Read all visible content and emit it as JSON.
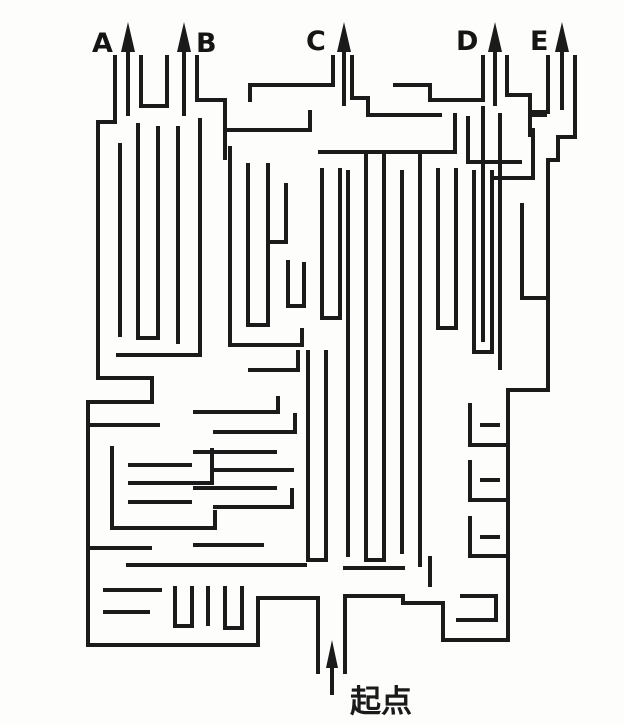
{
  "title": "maze-puzzle",
  "colors": {
    "background": "#fdfdfc",
    "wall": "#1b1b1b"
  },
  "wall_width": 4,
  "canvas": {
    "width": 624,
    "height": 725
  },
  "labels": {
    "a": "A",
    "b": "B",
    "c": "C",
    "d": "D",
    "e": "E",
    "start": "起点"
  },
  "arrows": [
    {
      "name": "exit-arrow-a",
      "x": 128,
      "shaft_y1": 116,
      "shaft_y2": 48,
      "tip_y": 22,
      "base_y": 52,
      "half_w": 7
    },
    {
      "name": "exit-arrow-b",
      "x": 184,
      "shaft_y1": 116,
      "shaft_y2": 48,
      "tip_y": 22,
      "base_y": 52,
      "half_w": 7
    },
    {
      "name": "exit-arrow-c",
      "x": 344,
      "shaft_y1": 106,
      "shaft_y2": 48,
      "tip_y": 22,
      "base_y": 52,
      "half_w": 7
    },
    {
      "name": "exit-arrow-d",
      "x": 495,
      "shaft_y1": 106,
      "shaft_y2": 48,
      "tip_y": 22,
      "base_y": 52,
      "half_w": 7
    },
    {
      "name": "exit-arrow-e",
      "x": 562,
      "shaft_y1": 110,
      "shaft_y2": 48,
      "tip_y": 22,
      "base_y": 52,
      "half_w": 7
    },
    {
      "name": "start-arrow",
      "x": 332,
      "shaft_y1": 695,
      "shaft_y2": 666,
      "tip_y": 640,
      "base_y": 668,
      "half_w": 6
    }
  ],
  "walls": [
    [
      [
        115,
        57
      ],
      [
        115,
        122
      ],
      [
        98,
        122
      ],
      [
        98,
        378
      ],
      [
        152,
        378
      ],
      [
        152,
        402
      ],
      [
        88,
        402
      ],
      [
        88,
        645
      ],
      [
        258,
        645
      ],
      [
        258,
        598
      ],
      [
        318,
        598
      ],
      [
        318,
        672
      ]
    ],
    [
      [
        141,
        57
      ],
      [
        141,
        106
      ],
      [
        167,
        106
      ],
      [
        167,
        57
      ]
    ],
    [
      [
        197,
        57
      ],
      [
        197,
        100
      ],
      [
        225,
        100
      ],
      [
        225,
        158
      ]
    ],
    [
      [
        333,
        57
      ],
      [
        333,
        85
      ],
      [
        250,
        85
      ],
      [
        250,
        100
      ]
    ],
    [
      [
        352,
        57
      ],
      [
        352,
        98
      ],
      [
        368,
        98
      ],
      [
        368,
        115
      ],
      [
        440,
        115
      ]
    ],
    [
      [
        483,
        57
      ],
      [
        483,
        100
      ],
      [
        430,
        100
      ],
      [
        430,
        85
      ],
      [
        395,
        85
      ]
    ],
    [
      [
        507,
        57
      ],
      [
        507,
        95
      ],
      [
        530,
        95
      ],
      [
        530,
        115
      ],
      [
        545,
        115
      ]
    ],
    [
      [
        548,
        57
      ],
      [
        548,
        112
      ],
      [
        530,
        112
      ],
      [
        530,
        135
      ]
    ],
    [
      [
        575,
        57
      ],
      [
        575,
        137
      ],
      [
        558,
        137
      ],
      [
        558,
        160
      ],
      [
        548,
        160
      ],
      [
        548,
        390
      ],
      [
        508,
        390
      ],
      [
        508,
        640
      ],
      [
        443,
        640
      ],
      [
        443,
        603
      ],
      [
        403,
        603
      ],
      [
        403,
        596
      ],
      [
        345,
        596
      ],
      [
        345,
        672
      ]
    ],
    [
      [
        120,
        145
      ],
      [
        120,
        335
      ]
    ],
    [
      [
        138,
        125
      ],
      [
        138,
        338
      ],
      [
        158,
        338
      ],
      [
        158,
        128
      ]
    ],
    [
      [
        178,
        128
      ],
      [
        178,
        342
      ]
    ],
    [
      [
        200,
        120
      ],
      [
        200,
        355
      ],
      [
        118,
        355
      ]
    ],
    [
      [
        228,
        130
      ],
      [
        310,
        130
      ],
      [
        310,
        112
      ]
    ],
    [
      [
        230,
        148
      ],
      [
        230,
        345
      ],
      [
        302,
        345
      ],
      [
        302,
        330
      ]
    ],
    [
      [
        248,
        165
      ],
      [
        248,
        325
      ],
      [
        268,
        325
      ],
      [
        268,
        165
      ]
    ],
    [
      [
        286,
        185
      ],
      [
        286,
        242
      ],
      [
        270,
        242
      ]
    ],
    [
      [
        288,
        262
      ],
      [
        288,
        306
      ],
      [
        304,
        306
      ],
      [
        304,
        264
      ]
    ],
    [
      [
        320,
        152
      ],
      [
        455,
        152
      ],
      [
        455,
        115
      ]
    ],
    [
      [
        322,
        170
      ],
      [
        322,
        318
      ],
      [
        340,
        318
      ],
      [
        340,
        170
      ]
    ],
    [
      [
        308,
        352
      ],
      [
        308,
        560
      ],
      [
        326,
        560
      ],
      [
        326,
        352
      ]
    ],
    [
      [
        348,
        172
      ],
      [
        348,
        555
      ]
    ],
    [
      [
        366,
        152
      ],
      [
        366,
        560
      ],
      [
        384,
        560
      ],
      [
        384,
        152
      ]
    ],
    [
      [
        402,
        172
      ],
      [
        402,
        552
      ]
    ],
    [
      [
        420,
        152
      ],
      [
        420,
        565
      ]
    ],
    [
      [
        438,
        170
      ],
      [
        438,
        328
      ],
      [
        456,
        328
      ],
      [
        456,
        170
      ]
    ],
    [
      [
        474,
        172
      ],
      [
        474,
        352
      ],
      [
        492,
        352
      ],
      [
        492,
        172
      ]
    ],
    [
      [
        468,
        118
      ],
      [
        468,
        162
      ],
      [
        520,
        162
      ]
    ],
    [
      [
        533,
        130
      ],
      [
        533,
        178
      ],
      [
        495,
        178
      ]
    ],
    [
      [
        483,
        108
      ],
      [
        483,
        340
      ]
    ],
    [
      [
        500,
        115
      ],
      [
        500,
        368
      ]
    ],
    [
      [
        522,
        205
      ],
      [
        522,
        298
      ],
      [
        544,
        298
      ]
    ],
    [
      [
        470,
        405
      ],
      [
        470,
        445
      ],
      [
        508,
        445
      ]
    ],
    [
      [
        482,
        425
      ],
      [
        498,
        425
      ]
    ],
    [
      [
        470,
        462
      ],
      [
        470,
        500
      ],
      [
        508,
        500
      ]
    ],
    [
      [
        482,
        480
      ],
      [
        498,
        480
      ]
    ],
    [
      [
        470,
        518
      ],
      [
        470,
        556
      ],
      [
        508,
        556
      ]
    ],
    [
      [
        482,
        537
      ],
      [
        498,
        537
      ]
    ],
    [
      [
        88,
        425
      ],
      [
        158,
        425
      ]
    ],
    [
      [
        112,
        448
      ],
      [
        112,
        528
      ],
      [
        215,
        528
      ],
      [
        215,
        512
      ]
    ],
    [
      [
        130,
        465
      ],
      [
        190,
        465
      ]
    ],
    [
      [
        130,
        483
      ],
      [
        212,
        483
      ],
      [
        212,
        450
      ]
    ],
    [
      [
        130,
        502
      ],
      [
        190,
        502
      ]
    ],
    [
      [
        195,
        412
      ],
      [
        278,
        412
      ],
      [
        278,
        398
      ]
    ],
    [
      [
        215,
        432
      ],
      [
        295,
        432
      ],
      [
        295,
        415
      ]
    ],
    [
      [
        195,
        452
      ],
      [
        275,
        452
      ]
    ],
    [
      [
        215,
        470
      ],
      [
        292,
        470
      ]
    ],
    [
      [
        195,
        488
      ],
      [
        275,
        488
      ]
    ],
    [
      [
        215,
        507
      ],
      [
        292,
        507
      ],
      [
        292,
        490
      ]
    ],
    [
      [
        195,
        545
      ],
      [
        262,
        545
      ]
    ],
    [
      [
        250,
        370
      ],
      [
        298,
        370
      ],
      [
        298,
        352
      ]
    ],
    [
      [
        88,
        548
      ],
      [
        150,
        548
      ]
    ],
    [
      [
        128,
        565
      ],
      [
        305,
        565
      ]
    ],
    [
      [
        105,
        590
      ],
      [
        160,
        590
      ]
    ],
    [
      [
        175,
        588
      ],
      [
        175,
        626
      ],
      [
        192,
        626
      ],
      [
        192,
        588
      ]
    ],
    [
      [
        208,
        588
      ],
      [
        208,
        624
      ]
    ],
    [
      [
        225,
        588
      ],
      [
        225,
        628
      ],
      [
        242,
        628
      ],
      [
        242,
        588
      ]
    ],
    [
      [
        105,
        612
      ],
      [
        148,
        612
      ]
    ],
    [
      [
        430,
        558
      ],
      [
        430,
        585
      ]
    ],
    [
      [
        458,
        620
      ],
      [
        496,
        620
      ],
      [
        496,
        596
      ],
      [
        462,
        596
      ]
    ],
    [
      [
        345,
        568
      ],
      [
        403,
        568
      ]
    ]
  ]
}
